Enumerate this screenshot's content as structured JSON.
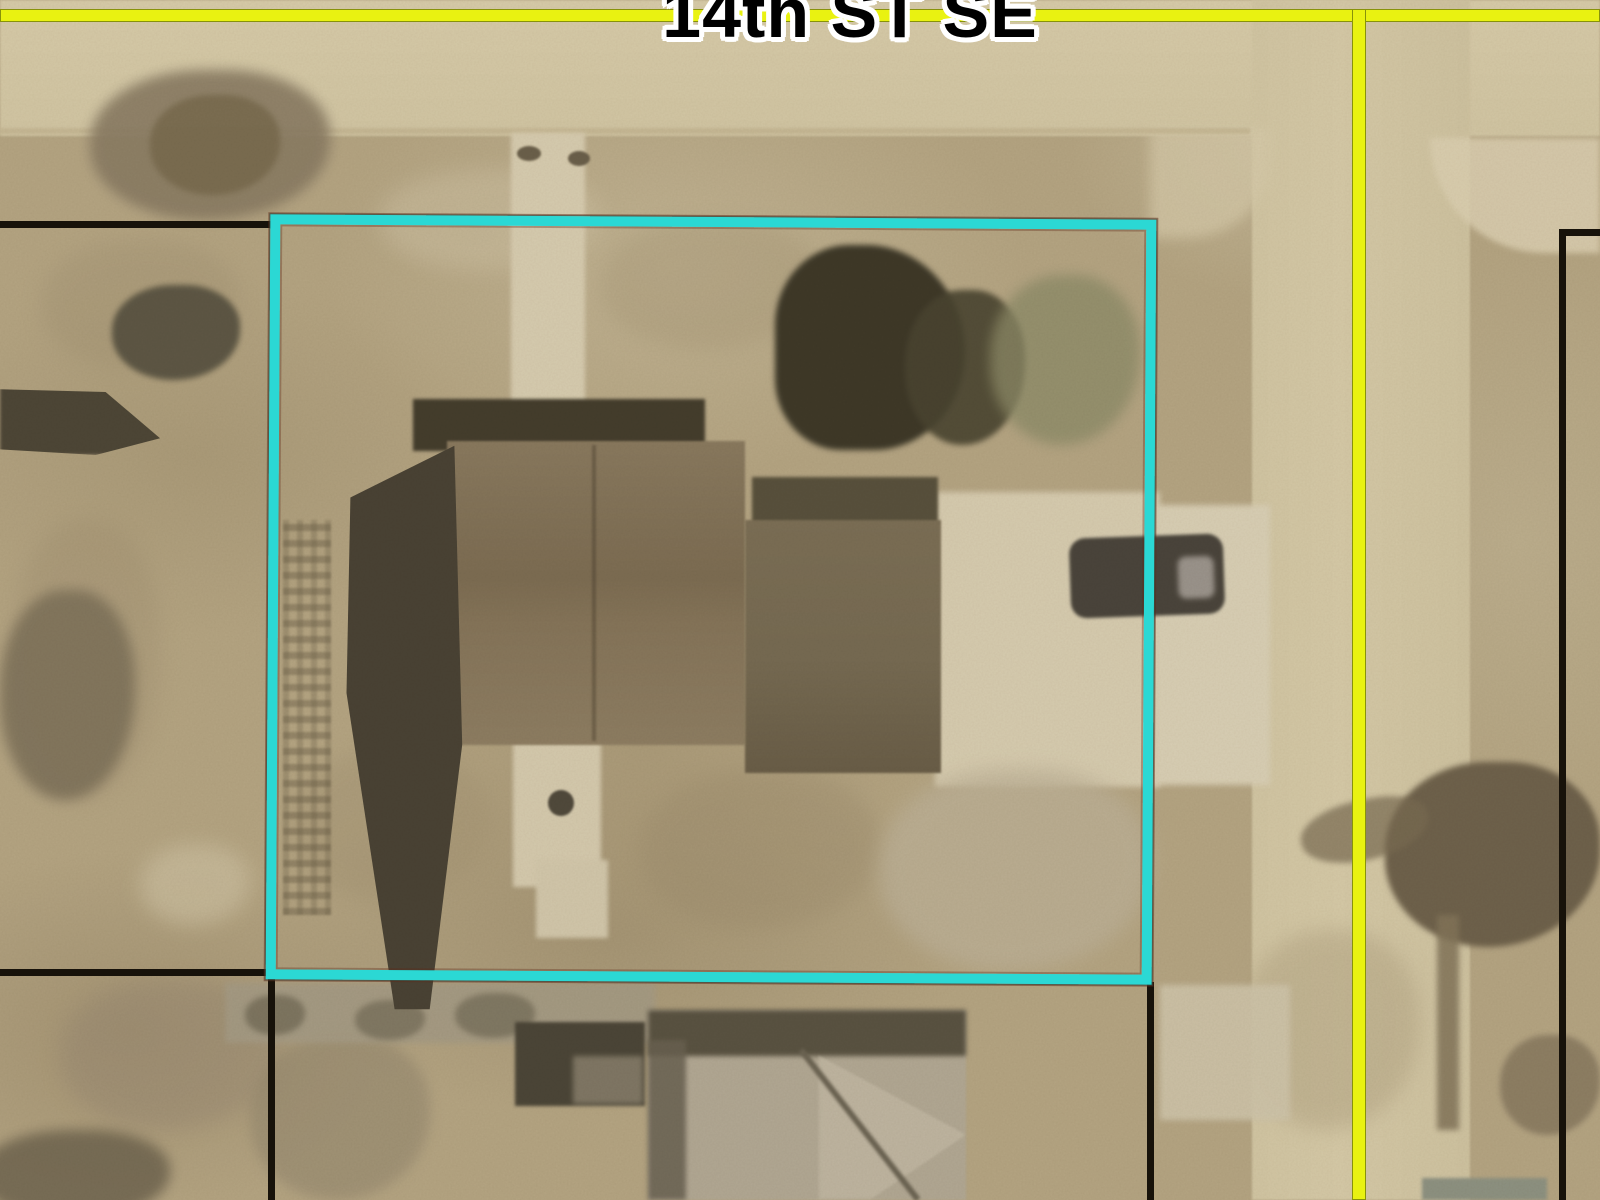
{
  "map": {
    "street_label": "14th ST SE",
    "selected_parcel": {
      "outline_color": "#2bd8d4",
      "shape": "rectangle"
    },
    "colors": {
      "street_centerline": "#e9f211",
      "parcel_boundary_line": "#17120a",
      "street_label_text": "#000000",
      "street_label_halo": "#ffffff",
      "ground": "#b5a47f",
      "road_surface": "#d5c8a3"
    }
  }
}
